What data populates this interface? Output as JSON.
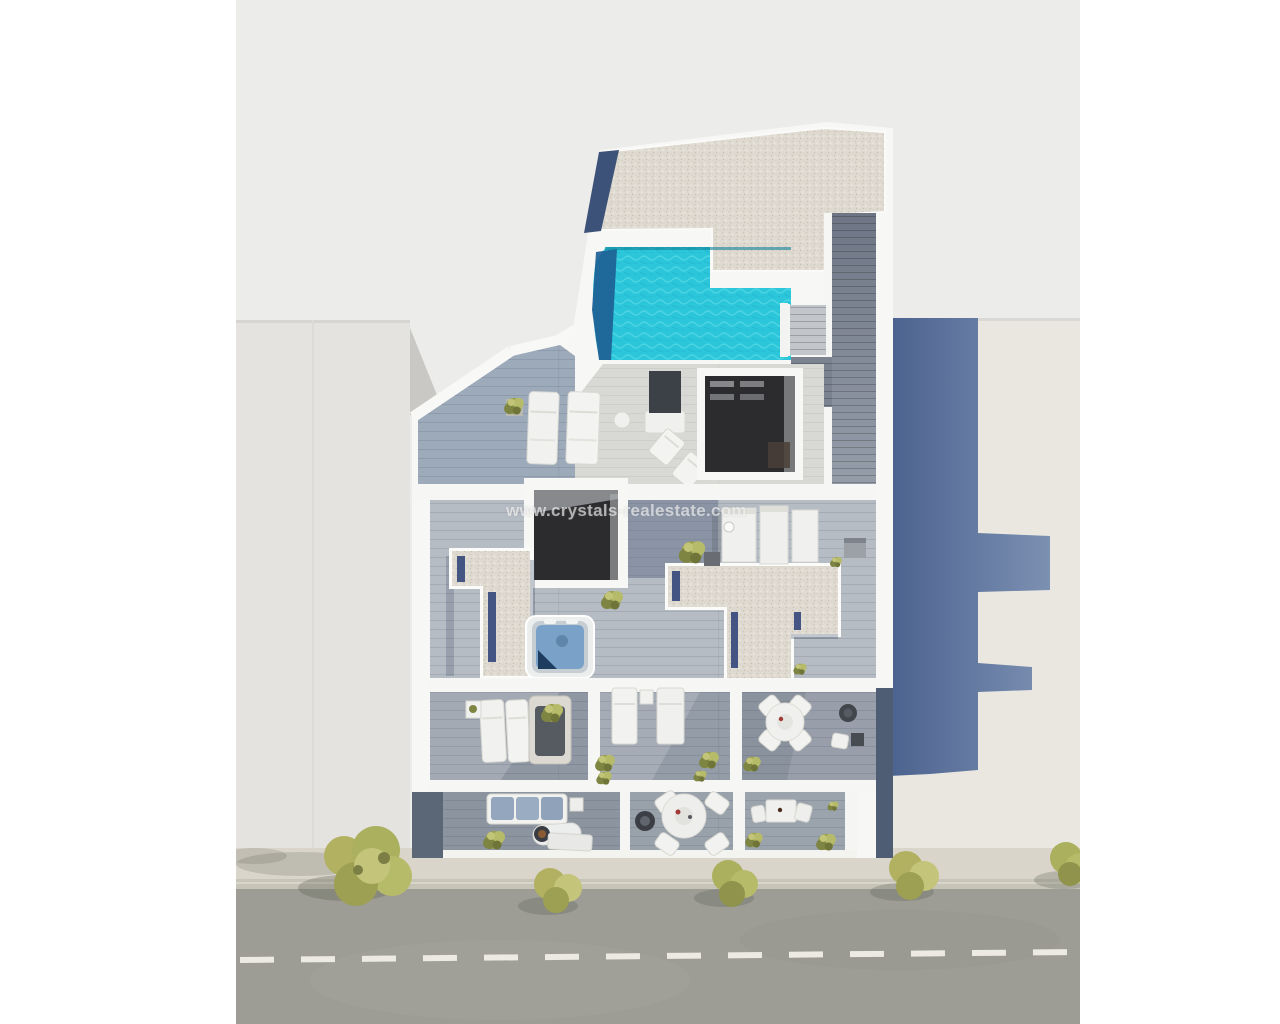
{
  "scene": {
    "description": "Top-down 3D architectural render of a residential building rooftop: pool terrace, solarium decks, jacuzzi, skylights, terraces and street-side balconies, flanked by neighbouring buildings and a street with trees"
  },
  "watermark": {
    "text": "www.crystals-realestate.com"
  },
  "colors": {
    "page_bg": "#ffffff",
    "photo_bg": "#ececea",
    "road": "#9d9d95",
    "road_marking": "#eceae2",
    "sidewalk": "#d9d5ca",
    "curb": "#c6c3b7",
    "neighbor_left": "#e4e3df",
    "neighbor_right": "#e9e7df",
    "cast_shadow_dark": "#4b628f",
    "cast_shadow_light": "#7c90b2",
    "wall_white": "#f7f7f5",
    "gravel_roof": "#dfdbd2",
    "deck_blue": "#9daaba",
    "deck_sunlit": "#d8d8d5",
    "deck_mid": "#b6bcc4",
    "deck_dark": "#8f97a3",
    "wood_walkway": "#7b8391",
    "pool_water": "#2bc6d9",
    "pool_deep_end": "#1e5f95",
    "dark_opening": "#2c2c2f",
    "jacuzzi_water": "#7aa2c9",
    "furniture_white": "#f1f1ef",
    "sofa_cushion": "#93a6bd",
    "tree_foliage": "#b2b161",
    "tree_foliage_dark": "#7c7f45",
    "tree_foliage_light": "#c5c47b"
  }
}
